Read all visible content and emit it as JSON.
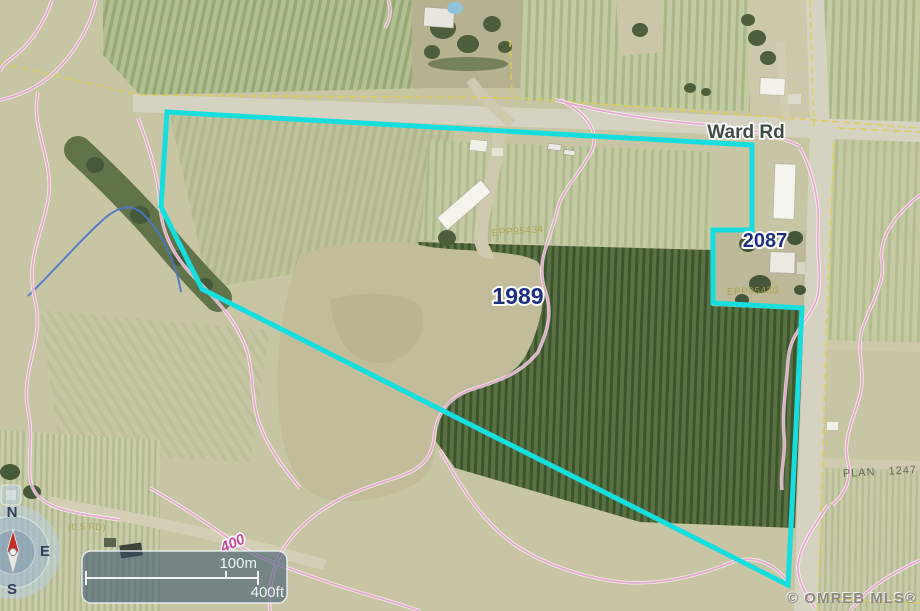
{
  "map": {
    "road_label": "Ward Rd",
    "parcel_labels": [
      "1989",
      "2087"
    ],
    "plan_labels": [
      "EPP95434",
      "EPP95430",
      "PLAN 1247"
    ],
    "road_note": "(0.5 RD)",
    "contour_label": "400",
    "watermark": "© OMREB MLS®",
    "boundary_color": "#17dede",
    "contour_color": "#eaa8d0",
    "parcel_label_color": "#1d2f7e"
  },
  "compass": {
    "n": "N",
    "e": "E",
    "s": "S"
  },
  "scale_bar": {
    "metric": "100m",
    "imperial": "400ft"
  }
}
